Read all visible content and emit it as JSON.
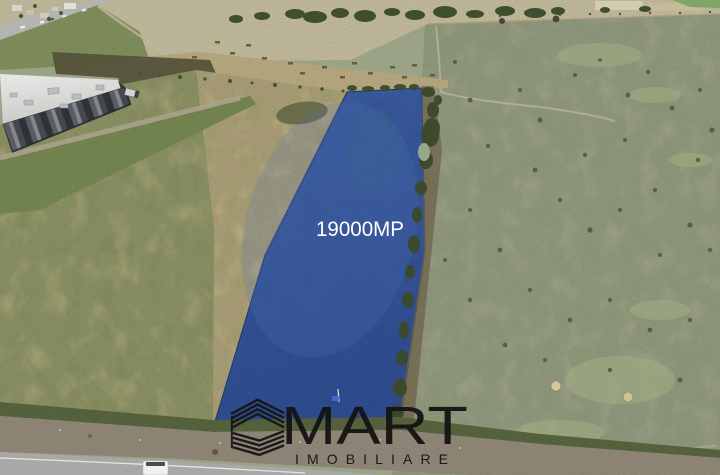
{
  "photo": {
    "type": "aerial-drone-photo",
    "description": "Drone view of farmland: highlighted blue plot for sale, warehouse top-left, highway corner, pasture right, asphalt road with white van at bottom",
    "area_label": "19000MP",
    "plot_color": "#3a5ca4",
    "label_color": "#ffffff"
  },
  "watermark": {
    "brand": "MART",
    "tagline": "IMOBILIARE",
    "color": "#141414",
    "icon": "striped-isometric-building-icon"
  },
  "palette": {
    "pasture_green": "#9aa385",
    "stubble_tan": "#b6a97f",
    "field_green": "#949b6b",
    "harvest_pale": "#cfc7a6",
    "tree_dark_green": "#3a4a2a",
    "road_gray": "#a8a8a6",
    "gravel": "#9c9281",
    "warehouse_roof": "#e0e0de",
    "warehouse_wall": "#45484d",
    "highway_gray": "#b4b4b1",
    "van_white": "#eef0ee"
  }
}
